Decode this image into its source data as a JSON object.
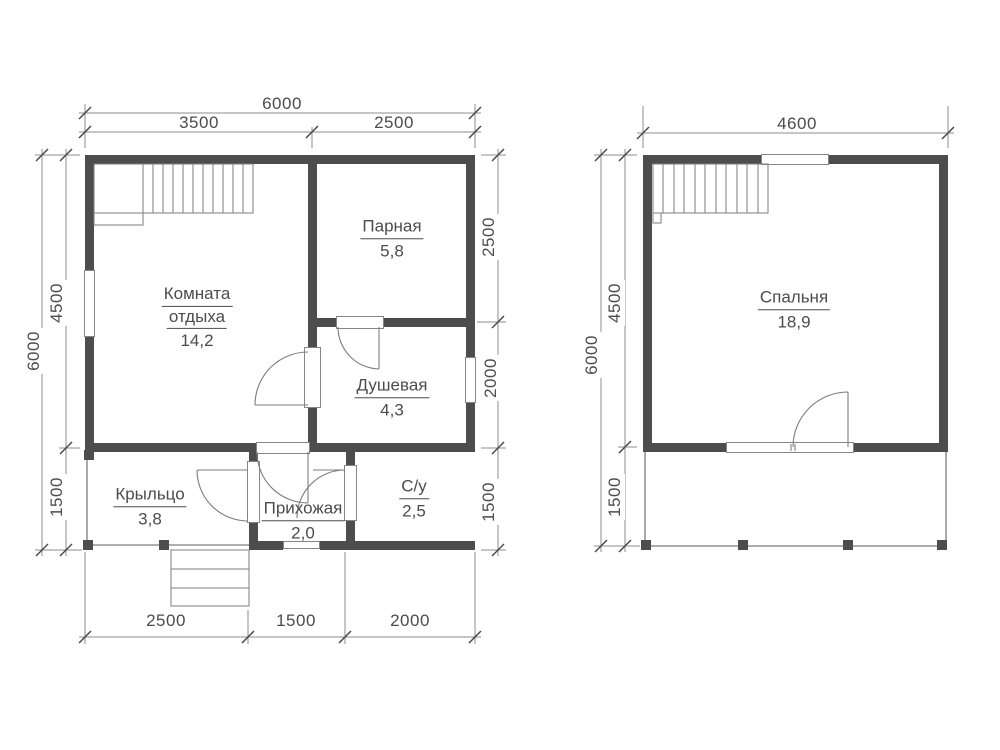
{
  "colors": {
    "wall": "#4d4d4d",
    "thin_line": "#7d7d7d",
    "dim_line": "#8d8d8d",
    "text": "#4c4c4c",
    "background": "#ffffff"
  },
  "floor1": {
    "rooms": {
      "lounge": {
        "name_line1": "Комната",
        "name_line2": "отдыха",
        "area": "14,2"
      },
      "steam": {
        "name": "Парная",
        "area": "5,8"
      },
      "shower": {
        "name": "Душевая",
        "area": "4,3"
      },
      "porch": {
        "name": "Крыльцо",
        "area": "3,8"
      },
      "hallway": {
        "name": "Прихожая",
        "area": "2,0"
      },
      "wc": {
        "name": "С/у",
        "area": "2,5"
      }
    },
    "dims": {
      "top_total": "6000",
      "top_left": "3500",
      "top_right": "2500",
      "left_total": "6000",
      "left_upper": "4500",
      "left_lower": "1500",
      "right_upper": "2500",
      "right_middle": "2000",
      "right_lower": "1500",
      "bottom_left": "2500",
      "bottom_middle": "1500",
      "bottom_right": "2000"
    }
  },
  "floor2": {
    "rooms": {
      "bedroom": {
        "name": "Спальня",
        "area": "18,9"
      }
    },
    "dims": {
      "top_total": "4600",
      "left_total": "6000",
      "left_upper": "4500",
      "left_lower": "1500"
    }
  }
}
